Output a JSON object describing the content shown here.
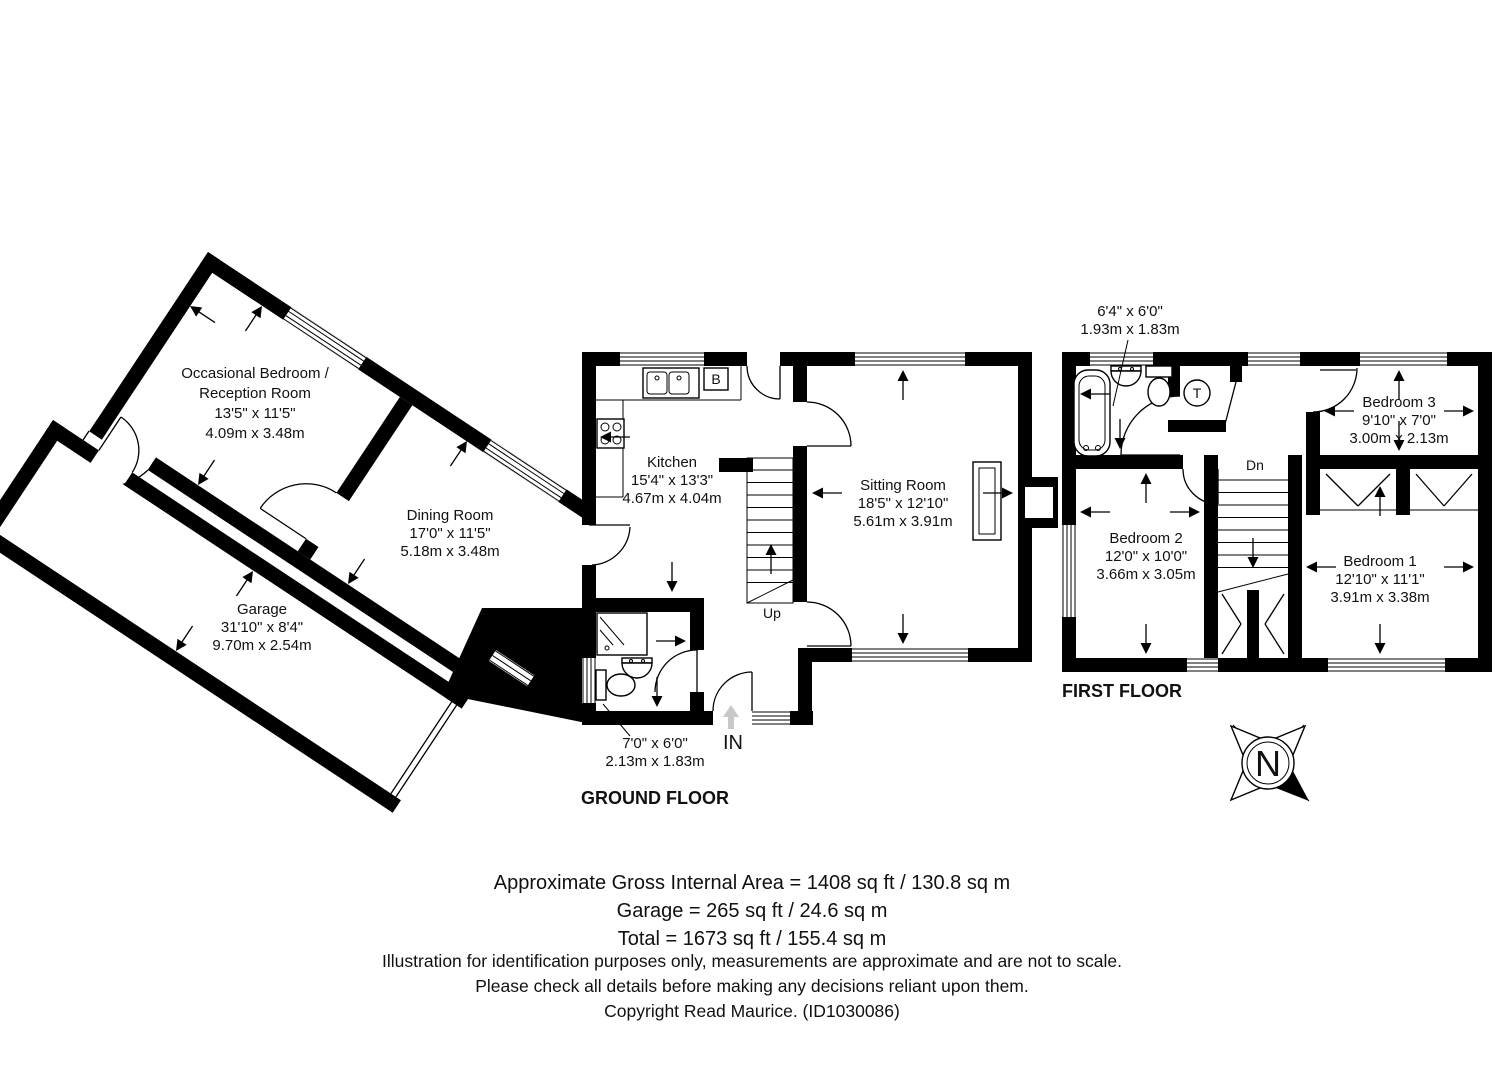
{
  "ground": {
    "title": "GROUND FLOOR",
    "occasional_bedroom": [
      "Occasional Bedroom /",
      "Reception Room",
      "13'5\" x 11'5\"",
      "4.09m x 3.48m"
    ],
    "dining_room": [
      "Dining Room",
      "17'0\" x 11'5\"",
      "5.18m x 3.48m"
    ],
    "garage": [
      "Garage",
      "31'10\" x 8'4\"",
      "9.70m x 2.54m"
    ],
    "kitchen": [
      "Kitchen",
      "15'4\" x 13'3\"",
      "4.67m x 4.04m"
    ],
    "sitting_room": [
      "Sitting Room",
      "18'5\" x 12'10\"",
      "5.61m x 3.91m"
    ],
    "shower_room": [
      "7'0\" x 6'0\"",
      "2.13m x 1.83m"
    ],
    "stairs_label": "Up",
    "entrance_label": "IN",
    "boiler_label": "B"
  },
  "first": {
    "title": "FIRST FLOOR",
    "bathroom": [
      "6'4\" x 6'0\"",
      "1.93m x 1.83m"
    ],
    "bedroom1": [
      "Bedroom 1",
      "12'10\" x 11'1\"",
      "3.91m x 3.38m"
    ],
    "bedroom2": [
      "Bedroom 2",
      "12'0\" x 10'0\"",
      "3.66m x 3.05m"
    ],
    "bedroom3": [
      "Bedroom 3",
      "9'10\" x 7'0\"",
      "3.00m x 2.13m"
    ],
    "stairs_label": "Dn",
    "tank_label": "T"
  },
  "compass": {
    "north_label": "N"
  },
  "footer": {
    "area_lines": [
      "Approximate Gross Internal Area = 1408 sq ft / 130.8 sq m",
      "Garage = 265 sq ft / 24.6 sq m",
      "Total = 1673 sq ft / 155.4 sq m"
    ],
    "disclaimer_lines": [
      "Illustration for identification purposes only, measurements are approximate and are not to scale.",
      "Please check all details before making any decisions reliant upon them."
    ],
    "copyright": "Copyright Read Maurice. (ID1030086)"
  },
  "colors": {
    "walls": "#000000",
    "background": "#ffffff",
    "entrance_arrow": "#c8c8c8"
  }
}
